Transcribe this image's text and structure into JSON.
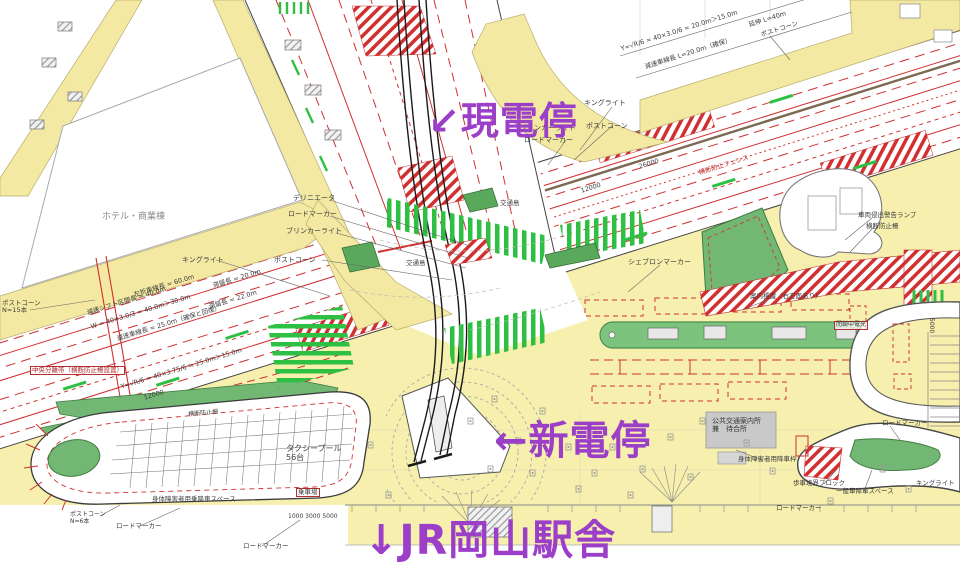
{
  "annotations": {
    "current_stop": "↙現電停",
    "new_stop": "←新電停",
    "station": "↓JR岡山駅舎"
  },
  "colors": {
    "purple": "#9b3fc8",
    "red": "#d03030",
    "green": "#72b874",
    "bright-green": "#2dc043",
    "yellow": "#f3e9a2",
    "plaza": "#f6efae"
  },
  "labels": [
    {
      "id": "hotel",
      "text": "ホテル・商業棟",
      "x": 102,
      "y": 212,
      "size": 9,
      "color": "#8a8a8a"
    },
    {
      "id": "kinglight-1",
      "text": "キングライト",
      "x": 182,
      "y": 256,
      "size": 7
    },
    {
      "id": "postcone-left",
      "text": "ポストコーン\nN=15本",
      "x": 2,
      "y": 300,
      "size": 6.5
    },
    {
      "id": "delineator",
      "text": "デリニエータ",
      "x": 293,
      "y": 194,
      "size": 7
    },
    {
      "id": "roadmarker-1",
      "text": "ロードマーカー",
      "x": 288,
      "y": 210,
      "size": 7
    },
    {
      "id": "blinker-1",
      "text": "ブリンカーライト",
      "x": 286,
      "y": 227,
      "size": 7
    },
    {
      "id": "postcone-2",
      "text": "ポストコーン",
      "x": 274,
      "y": 256,
      "size": 7
    },
    {
      "id": "leftturn-len",
      "text": "左折車線長 = 60.0m",
      "x": 133,
      "y": 292,
      "size": 6.5,
      "rot": -17
    },
    {
      "id": "tairyu-1",
      "text": "滞留長 = 20.0m",
      "x": 212,
      "y": 283,
      "size": 6.5,
      "rot": -17
    },
    {
      "id": "tairyu-2",
      "text": "滞留長 = 22.0m",
      "x": 208,
      "y": 304,
      "size": 6.5,
      "rot": -17
    },
    {
      "id": "shift-len",
      "text": "減速シフト区間長 = 40.0m",
      "x": 86,
      "y": 310,
      "size": 6.5,
      "rot": -17
    },
    {
      "id": "w-formula",
      "text": "W = 40×3.0/3 = 40.0m＞30.0m",
      "x": 90,
      "y": 324,
      "size": 6.5,
      "rot": -17
    },
    {
      "id": "gensoku-left",
      "text": "減速車線長 = 25.0m（確保と回復）",
      "x": 116,
      "y": 336,
      "size": 6.5,
      "rot": -17
    },
    {
      "id": "formula-mid",
      "text": "Y=√R/6 = 40×3.75/6 ≒ 25.0m＞15.0m",
      "x": 120,
      "y": 384,
      "size": 6.5,
      "rot": -17
    },
    {
      "id": "dim-12000",
      "text": "12000",
      "x": 143,
      "y": 395,
      "size": 6.5,
      "rot": -17
    },
    {
      "id": "median",
      "text": "中央分離帯（横断防止柵設置）",
      "x": 30,
      "y": 366,
      "size": 6.5,
      "color": "#b03030",
      "boxed": true
    },
    {
      "id": "formula-tr",
      "text": "Y=√R/6 = 40×3.0/6 = 20.0m＞15.0m",
      "x": 620,
      "y": 46,
      "size": 6.5,
      "rot": -17.5
    },
    {
      "id": "gensoku-tr",
      "text": "減速車線長 L=20.0m（確保）",
      "x": 644,
      "y": 64,
      "size": 6.5,
      "rot": -17.5
    },
    {
      "id": "enshin",
      "text": "延伸 L=40m",
      "x": 748,
      "y": 22,
      "size": 6.5,
      "rot": -17.5
    },
    {
      "id": "postcone-tr",
      "text": "ポストコーン",
      "x": 760,
      "y": 32,
      "size": 6.5,
      "rot": -17.5
    },
    {
      "id": "kinglight-genden",
      "text": "キングライト",
      "x": 584,
      "y": 99,
      "size": 7
    },
    {
      "id": "postcone-genden",
      "text": "ポストコーン",
      "x": 586,
      "y": 122,
      "size": 7
    },
    {
      "id": "blinker-genden",
      "text": "ブリンカーライト",
      "x": 520,
      "y": 124,
      "size": 7
    },
    {
      "id": "roadmarker-genden",
      "text": "ロードマーカー",
      "x": 524,
      "y": 136,
      "size": 7
    },
    {
      "id": "chevron",
      "text": "シェブロンマーカー",
      "x": 628,
      "y": 258,
      "size": 7
    },
    {
      "id": "fence-road",
      "text": "横断防止フェンス",
      "x": 698,
      "y": 170,
      "size": 6.5,
      "rot": -17.5,
      "color": "#c03030"
    },
    {
      "id": "warn-lamp",
      "text": "車両侵出警告ランプ",
      "x": 858,
      "y": 212,
      "size": 6.5
    },
    {
      "id": "oudan-right",
      "text": "横断防止柵",
      "x": 866,
      "y": 223,
      "size": 6.5
    },
    {
      "id": "annai",
      "text": "案内標識（右方面あり）",
      "x": 750,
      "y": 293,
      "size": 6.5
    },
    {
      "id": "denko",
      "text": "閉鎖中電光",
      "x": 834,
      "y": 321,
      "size": 6,
      "boxed": true
    },
    {
      "id": "koutsujima-1",
      "text": "交通島",
      "x": 500,
      "y": 200,
      "size": 6.5
    },
    {
      "id": "koutsujima-2",
      "text": "交通島",
      "x": 406,
      "y": 260,
      "size": 6.5
    },
    {
      "id": "dim-26000",
      "text": "26000",
      "x": 638,
      "y": 164,
      "size": 6.5,
      "rot": -17.5
    },
    {
      "id": "dim-12000b",
      "text": "12000",
      "x": 580,
      "y": 188,
      "size": 6.5,
      "rot": -17.5
    },
    {
      "id": "koukyo-box",
      "text": "公共交通案内所\n兼　待合所",
      "x": 712,
      "y": 417,
      "size": 7,
      "color": "#333333"
    },
    {
      "id": "shintai-right",
      "text": "身体障害者用降車枠",
      "x": 738,
      "y": 456,
      "size": 6.5
    },
    {
      "id": "hosha-block",
      "text": "歩車境界ブロック",
      "x": 793,
      "y": 480,
      "size": 6.5
    },
    {
      "id": "ippan-drop",
      "text": "一般車降車スペース",
      "x": 836,
      "y": 488,
      "size": 6.5
    },
    {
      "id": "taxi-pool",
      "text": "タクシープール\n56台",
      "x": 286,
      "y": 444,
      "size": 8
    },
    {
      "id": "jousha",
      "text": "乗車場",
      "x": 296,
      "y": 488,
      "size": 6.5,
      "boxed": true
    },
    {
      "id": "shintai-left",
      "text": "身体障害者用乗降車スペース",
      "x": 152,
      "y": 496,
      "size": 6.5
    },
    {
      "id": "dims-bottom",
      "text": "1000 3000 5000",
      "x": 288,
      "y": 514,
      "size": 6
    },
    {
      "id": "roadmarker-b1",
      "text": "ロードマーカー",
      "x": 116,
      "y": 523,
      "size": 6.5
    },
    {
      "id": "postcone-b",
      "text": "ポストコーン\nN=6本",
      "x": 70,
      "y": 512,
      "size": 6
    },
    {
      "id": "roadmarker-b2",
      "text": "ロードマーカー",
      "x": 243,
      "y": 543,
      "size": 6.5
    },
    {
      "id": "roadmarker-r1",
      "text": "ロードマーカー",
      "x": 882,
      "y": 420,
      "size": 6.5
    },
    {
      "id": "roadmarker-r2",
      "text": "ロードマーカー",
      "x": 776,
      "y": 505,
      "size": 6.5
    },
    {
      "id": "kinglight-br",
      "text": "キングライト",
      "x": 916,
      "y": 480,
      "size": 6.5
    },
    {
      "id": "oudan-green",
      "text": "横断防止柵",
      "x": 188,
      "y": 412,
      "size": 6,
      "rot": -5
    },
    {
      "id": "dim-5000",
      "text": "5000",
      "x": 934,
      "y": 318,
      "size": 6,
      "rot": 90
    }
  ]
}
